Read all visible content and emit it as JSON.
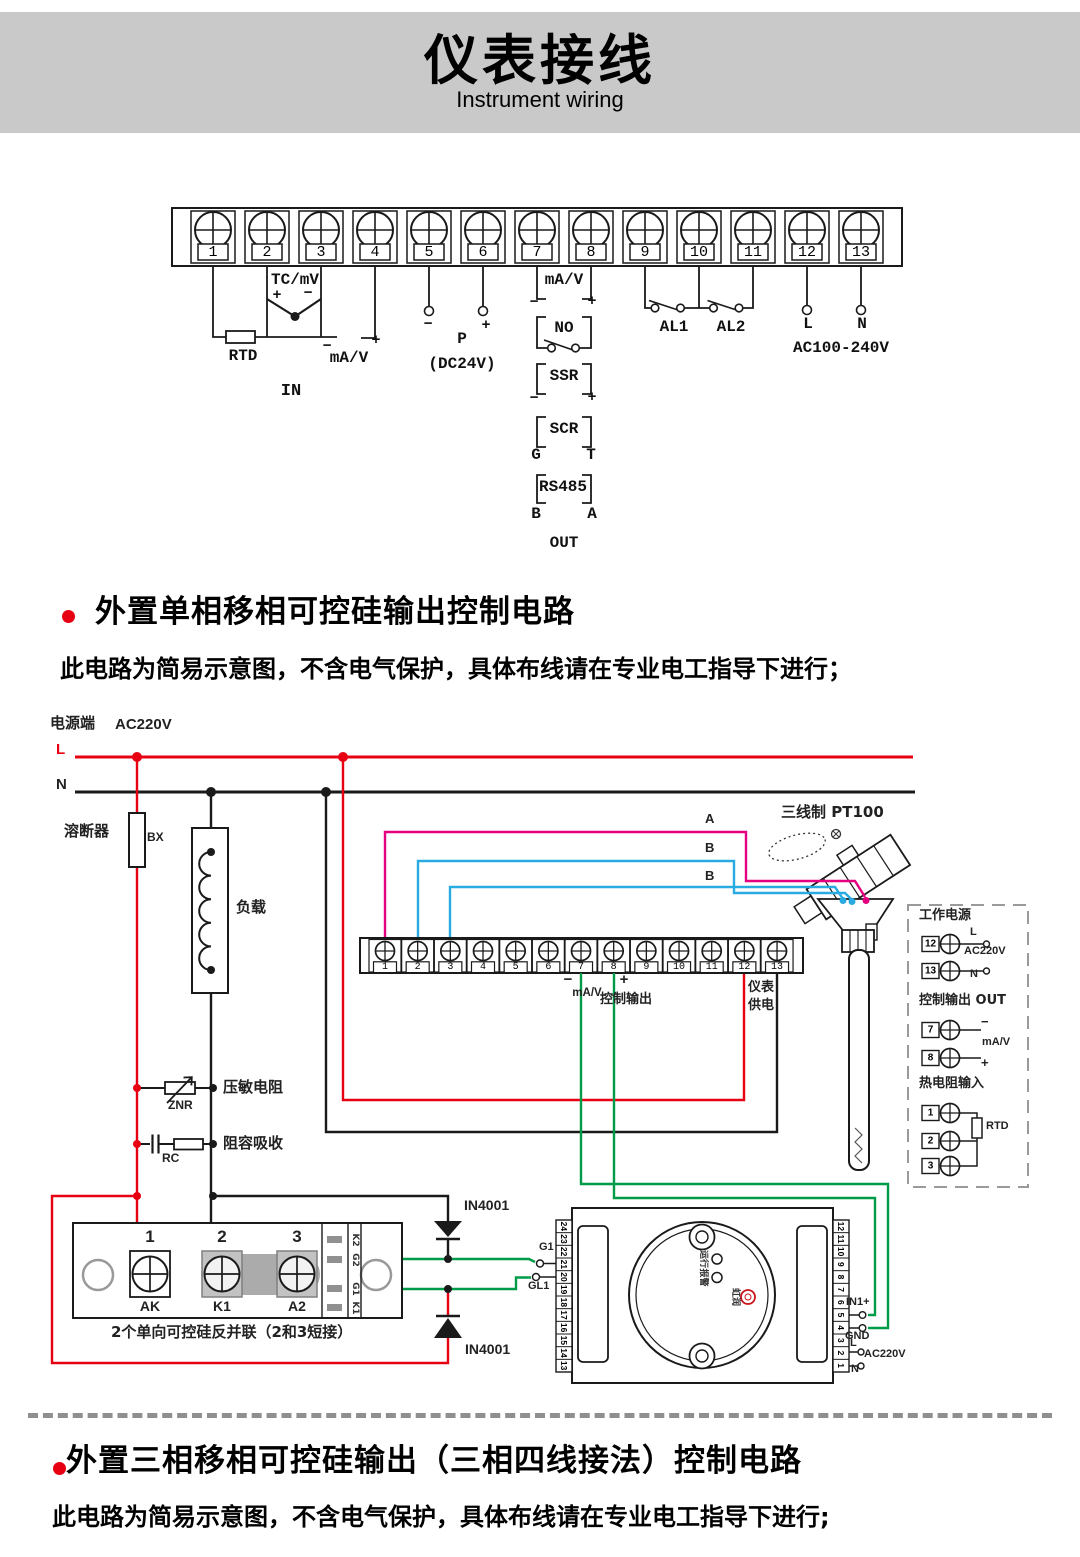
{
  "header": {
    "title": "仪表接线",
    "subtitle": "Instrument wiring"
  },
  "terminal_block": {
    "numbers": [
      "1",
      "2",
      "3",
      "4",
      "5",
      "6",
      "7",
      "8",
      "9",
      "10",
      "11",
      "12",
      "13"
    ],
    "tc_label": "TC/mV",
    "tc_plus": "+",
    "tc_minus": "−",
    "rtd_label": "RTD",
    "ain_minus": "−",
    "ain_label": "mA/V",
    "ain_plus": "+",
    "in_label": "IN",
    "ps_minus": "−",
    "ps_plus": "+",
    "ps_label": "P",
    "ps_sub": "(DC24V)",
    "aout_label": "mA/V",
    "aout_minus": "−",
    "aout_plus": "+",
    "no_label": "NO",
    "ssr_label": "SSR",
    "ssr_minus": "−",
    "ssr_plus": "+",
    "scr_label": "SCR",
    "scr_g": "G",
    "scr_t": "T",
    "rs485_label": "RS485",
    "rs485_b": "B",
    "rs485_a": "A",
    "out_label": "OUT",
    "al1_label": "AL1",
    "al2_label": "AL2",
    "line_label": "L",
    "neutral_label": "N",
    "mains_label": "AC100-240V"
  },
  "section1": {
    "title": "外置单相移相可控硅输出控制电路",
    "note": "此电路为简易示意图，不含电气保护，具体布线请在专业电工指导下进行；"
  },
  "circuit": {
    "supply_label": "电源端",
    "supply_voltage": "AC220V",
    "line": "L",
    "neutral": "N",
    "fuse_label": "溶断器",
    "fuse_code": "BX",
    "load_label": "负载",
    "varistor_label": "压敏电阻",
    "varistor_code": "ZNR",
    "snubber_label": "阻容吸收",
    "snubber_code": "RC",
    "pt100_label": "三线制 PT100",
    "wire_a": "A",
    "wire_b1": "B",
    "wire_b2": "B",
    "strip_numbers": [
      "1",
      "2",
      "3",
      "4",
      "5",
      "6",
      "7",
      "8",
      "9",
      "10",
      "11",
      "12",
      "13"
    ],
    "out_minus": "−",
    "out_plus": "+",
    "out_signal": "mA/V",
    "out_label": "控制输出",
    "inst_power_line1": "仪表",
    "inst_power_line2": "供电",
    "diode_top": "IN4001",
    "diode_bottom": "IN4001",
    "gate1": "G1",
    "gate2": "GL1",
    "scr_module": {
      "numbers": [
        "1",
        "2",
        "3"
      ],
      "labels": [
        "AK",
        "K1",
        "A2"
      ],
      "tabs": [
        "K2",
        "G2",
        "G1",
        "K1"
      ],
      "caption": "2个单向可控硅反并联（2和3短接）"
    },
    "trigger_module": {
      "left_numbers": [
        "24",
        "23",
        "22",
        "21",
        "20",
        "19",
        "18",
        "17",
        "16",
        "15",
        "14",
        "13"
      ],
      "right_numbers": [
        "12",
        "11",
        "10",
        "9",
        "8",
        "7",
        "6",
        "5",
        "4",
        "3",
        "2",
        "1"
      ],
      "run": "运行",
      "alarm": "报警",
      "brand": "虹润",
      "in1": "IN1+",
      "gnd": "GND",
      "line": "L",
      "voltage": "AC220V",
      "neutral": "N"
    },
    "panel": {
      "power_title": "工作电源",
      "power_line": "L",
      "power_voltage": "AC220V",
      "power_neutral": "N",
      "ctrl_title": "控制输出 OUT",
      "ctrl_minus": "−",
      "ctrl_signal": "mA/V",
      "ctrl_plus": "+",
      "rtd_title": "热电阻输入",
      "rtd_label": "RTD",
      "numbers": [
        "12",
        "13",
        "7",
        "8",
        "1",
        "2",
        "3"
      ]
    }
  },
  "section2": {
    "title": "外置三相移相可控硅输出（三相四线接法）控制电路",
    "note": "此电路为简易示意图，不含电气保护，具体布线请在专业电工指导下进行;"
  },
  "colors": {
    "red": "#e60012",
    "magenta": "#e4007f",
    "blue": "#29abe2",
    "green": "#009b48",
    "banner": "#c9c9c9"
  }
}
